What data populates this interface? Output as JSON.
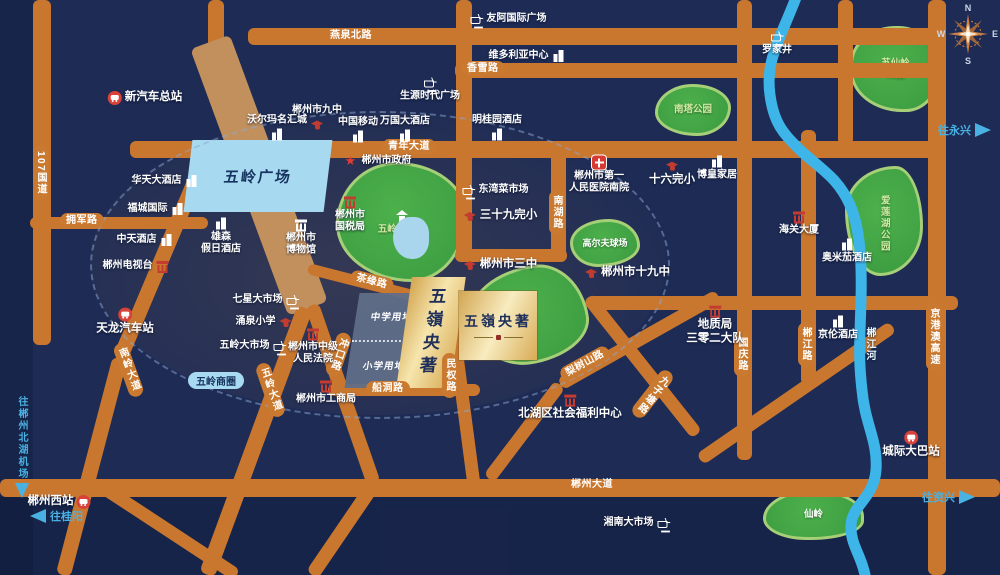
{
  "project": {
    "name": "五嶺央著",
    "plaza_label": "五岭广场",
    "business_circle_badge": "五岭商圈",
    "site_blocks": [
      {
        "label": "中学用地"
      },
      {
        "label": "小学用地"
      }
    ]
  },
  "roads": {
    "g107": "107国道",
    "yanquanbei": "燕泉北路",
    "xiangxue": "香雪路",
    "qingnian": "青年大道",
    "yongjun": "拥军路",
    "nanhu": "南湖路",
    "chayuan": "茶缘路",
    "chongkou": "冲口路",
    "chuandong": "船洞路",
    "minquan": "民权路",
    "wulingdadao": "五岭大道",
    "nanlingdadao": "南岭大道",
    "lishushan": "梨树山路",
    "jiuzitang": "九子塘路",
    "chenzhoudadao": "郴州大道",
    "guoqing": "国庆路",
    "chenjianglu": "郴江路",
    "jinggangao": "京港澳高速"
  },
  "river": {
    "label": "郴江河"
  },
  "parks": {
    "wulingge": "五岭阁公园",
    "suxianling_lines": [
      "苏仙岭",
      "公园"
    ],
    "nanta": "南塔公园",
    "ailianhu": "爱莲湖公园",
    "golf": "高尔夫球场",
    "xianling": "仙岭"
  },
  "arrows": {
    "yongxing": "往永兴",
    "zixing": "往资兴",
    "guiyang": "往桂阳",
    "airport": "往郴州北湖机场"
  },
  "compass": {
    "n": "N",
    "e": "E",
    "s": "S",
    "w": "W"
  },
  "pois": [
    {
      "label": "新汽车总站",
      "icon": "bus",
      "x": 145,
      "y": 98,
      "side": "right",
      "size": "lg"
    },
    {
      "label": "郴州市九中",
      "icon": "cap",
      "x": 317,
      "y": 118,
      "side": "top"
    },
    {
      "label": "沃尔玛名汇城",
      "icon": "building",
      "x": 277,
      "y": 128,
      "side": "top"
    },
    {
      "label": "中国移动",
      "icon": "building",
      "x": 358,
      "y": 130,
      "side": "top"
    },
    {
      "label": "万国大酒店",
      "icon": "building",
      "x": 405,
      "y": 129,
      "side": "top"
    },
    {
      "label": "明桂园酒店",
      "icon": "building",
      "x": 497,
      "y": 128,
      "side": "top"
    },
    {
      "label": "友阿国际广场",
      "icon": "cart",
      "x": 508,
      "y": 19,
      "side": "right"
    },
    {
      "label": "维多利亚中心",
      "icon": "building",
      "x": 527,
      "y": 56,
      "side": "left"
    },
    {
      "label": "生源时代广场",
      "icon": "cart",
      "x": 430,
      "y": 89,
      "side": "bottom"
    },
    {
      "label": "罗家井",
      "icon": "cart",
      "x": 777,
      "y": 43,
      "side": "bottom"
    },
    {
      "label": "华天大酒店",
      "icon": "building",
      "x": 165,
      "y": 181,
      "side": "left"
    },
    {
      "label": "福城国际",
      "icon": "building",
      "x": 156,
      "y": 209,
      "side": "left"
    },
    {
      "label": "中天酒店",
      "icon": "building",
      "x": 145,
      "y": 240,
      "side": "left"
    },
    {
      "label": "郴州电视台",
      "icon": "inst-red",
      "x": 136,
      "y": 266,
      "side": "left"
    },
    {
      "lines": [
        "雄森",
        "假日酒店"
      ],
      "icon": "building",
      "x": 221,
      "y": 236,
      "side": "bottom"
    },
    {
      "lines": [
        "郴州市",
        "博物馆"
      ],
      "icon": "inst-white",
      "x": 301,
      "y": 237,
      "side": "bottom"
    },
    {
      "label": "郴州市政府",
      "icon": "star",
      "x": 378,
      "y": 161,
      "side": "right"
    },
    {
      "lines": [
        "郴州市",
        "国税局"
      ],
      "icon": "inst-red",
      "x": 350,
      "y": 214,
      "side": "bottom"
    },
    {
      "label": "东湾菜市场",
      "icon": "cart",
      "x": 495,
      "y": 190,
      "side": "right"
    },
    {
      "label": "三十九完小",
      "icon": "cap",
      "x": 500,
      "y": 216,
      "side": "right",
      "size": "lg"
    },
    {
      "lines": [
        "郴州市第一",
        "人民医院南院"
      ],
      "icon": "cross",
      "x": 599,
      "y": 175,
      "side": "bottom"
    },
    {
      "label": "十六完小",
      "icon": "cap",
      "x": 672,
      "y": 173,
      "side": "bottom",
      "size": "lg"
    },
    {
      "label": "博皇家居",
      "icon": "building",
      "x": 717,
      "y": 168,
      "side": "bottom"
    },
    {
      "label": "海关大厦",
      "icon": "inst-red",
      "x": 799,
      "y": 223,
      "side": "bottom"
    },
    {
      "label": "奥米茄酒店",
      "icon": "building",
      "x": 847,
      "y": 251,
      "side": "bottom"
    },
    {
      "label": "郴州市三中",
      "icon": "cap",
      "x": 500,
      "y": 265,
      "side": "right",
      "size": "lg"
    },
    {
      "label": "郴州市十九中",
      "icon": "cap",
      "x": 627,
      "y": 273,
      "side": "right",
      "size": "lg"
    },
    {
      "label": "七星大市场",
      "icon": "cart",
      "x": 266,
      "y": 300,
      "side": "left"
    },
    {
      "label": "涌泉小学",
      "icon": "cap",
      "x": 264,
      "y": 322,
      "side": "left"
    },
    {
      "label": "五岭大市场",
      "icon": "cart",
      "x": 253,
      "y": 346,
      "side": "left"
    },
    {
      "lines": [
        "郴州市中级",
        "人民法院"
      ],
      "icon": "inst-red",
      "x": 313,
      "y": 346,
      "side": "bottom"
    },
    {
      "label": "郴州市工商局",
      "icon": "inst-red",
      "x": 326,
      "y": 392,
      "side": "bottom"
    },
    {
      "label": "天龙汽车站",
      "icon": "bus",
      "x": 125,
      "y": 322,
      "side": "bottom",
      "size": "lg"
    },
    {
      "lines": [
        "地质局",
        "三零二大队"
      ],
      "icon": "inst-red",
      "x": 715,
      "y": 325,
      "side": "bottom",
      "size": "lg"
    },
    {
      "label": "京伦酒店",
      "icon": "building",
      "x": 838,
      "y": 328,
      "side": "bottom"
    },
    {
      "label": "北湖区社会福利中心",
      "icon": "inst-red",
      "x": 570,
      "y": 407,
      "side": "bottom",
      "size": "lg"
    },
    {
      "label": "郴州西站",
      "icon": "train",
      "x": 59,
      "y": 502,
      "side": "left",
      "size": "lg"
    },
    {
      "label": "城际大巴站",
      "icon": "bus",
      "x": 911,
      "y": 445,
      "side": "bottom",
      "size": "lg"
    },
    {
      "label": "湘南大市场",
      "icon": "cart",
      "x": 637,
      "y": 523,
      "side": "left"
    }
  ]
}
